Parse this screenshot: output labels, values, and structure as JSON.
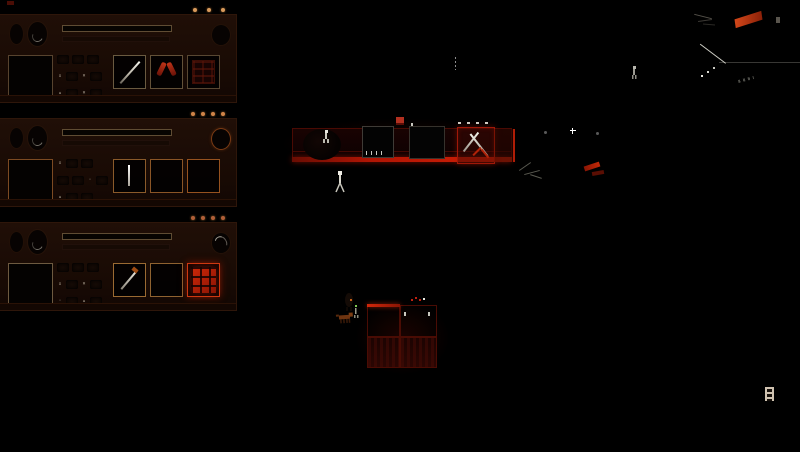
{
  "app": {
    "title": "colony survival game screen",
    "background": "#000000"
  },
  "colors": {
    "panel_bg": "#1d0d06",
    "accent_red": "#b51504",
    "bright_red": "#c8220a",
    "dim_red": "#5a0e05",
    "warm_dot": "#d89a5c"
  },
  "glyphs": {
    "sq": "▫",
    "x": "×",
    "tri": "▴",
    "dotg": "·"
  },
  "unit_panels": [
    {
      "name": "unit-1",
      "status_dots": 3,
      "dot_color": "#d89a5c",
      "dot_gap": "10px",
      "portrait_border": "#57432e",
      "gauge_style": "plain",
      "slots": [
        {
          "item": "rifle",
          "border": "#6a5a40",
          "glow": false
        },
        {
          "item": "wishbone",
          "border": "#635138",
          "glow": false
        },
        {
          "item": "crate",
          "border": "#584732",
          "glow": false
        }
      ],
      "stat_rows": [
        [
          "blob",
          "blob",
          "blob"
        ],
        [
          "sq",
          "blob",
          "x",
          "blob"
        ],
        [
          "tri",
          "blob",
          "x",
          "blob"
        ]
      ]
    },
    {
      "name": "unit-2",
      "status_dots": 4,
      "dot_color": "#d08448",
      "dot_gap": "6px",
      "portrait_border": "#7c4a22",
      "gauge_style": "ring",
      "slots": [
        {
          "item": "rod",
          "border": "#8a5a2a",
          "glow": false
        },
        {
          "item": "empty",
          "border": "#8a5526",
          "glow": false
        },
        {
          "item": "empty",
          "border": "#96521f",
          "glow": false
        }
      ],
      "stat_rows": [
        [
          "sq",
          "blob",
          "blob"
        ],
        [
          "blob",
          "blob",
          "dotg",
          "blob"
        ],
        [
          "tri",
          "blob",
          "blob"
        ]
      ]
    },
    {
      "name": "unit-3",
      "status_dots": 4,
      "dot_color": "#b05f38",
      "dot_gap": "6px",
      "portrait_border": "#6d5a40",
      "gauge_style": "dial",
      "slots": [
        {
          "item": "pick",
          "border": "#9a6a32",
          "glow": false
        },
        {
          "item": "empty",
          "border": "#8f6230",
          "glow": false
        },
        {
          "item": "redgrid",
          "border": "#cf3a12",
          "glow": true
        }
      ],
      "stat_rows": [
        [
          "blob",
          "blob",
          "blob"
        ],
        [
          "sq",
          "blob",
          "x",
          "blob"
        ],
        [
          "dotg",
          "blob",
          "tri",
          "blob"
        ]
      ]
    }
  ],
  "scene": {
    "structures": [
      "base-platform",
      "storage-box-a",
      "storage-box-b",
      "tool-station",
      "platform-edge",
      "room-grid"
    ],
    "units": [
      "survivor-on-platform",
      "survivor-below-platform",
      "survivor-far-right",
      "creature-dog",
      "creature-lurker",
      "survivor-marker"
    ],
    "markers": [
      "flag-marker",
      "resource-marker",
      "light-sparkles",
      "zipline",
      "exit-ladder"
    ],
    "accent_red": "#b51504",
    "bright_red": "#c8220a"
  }
}
